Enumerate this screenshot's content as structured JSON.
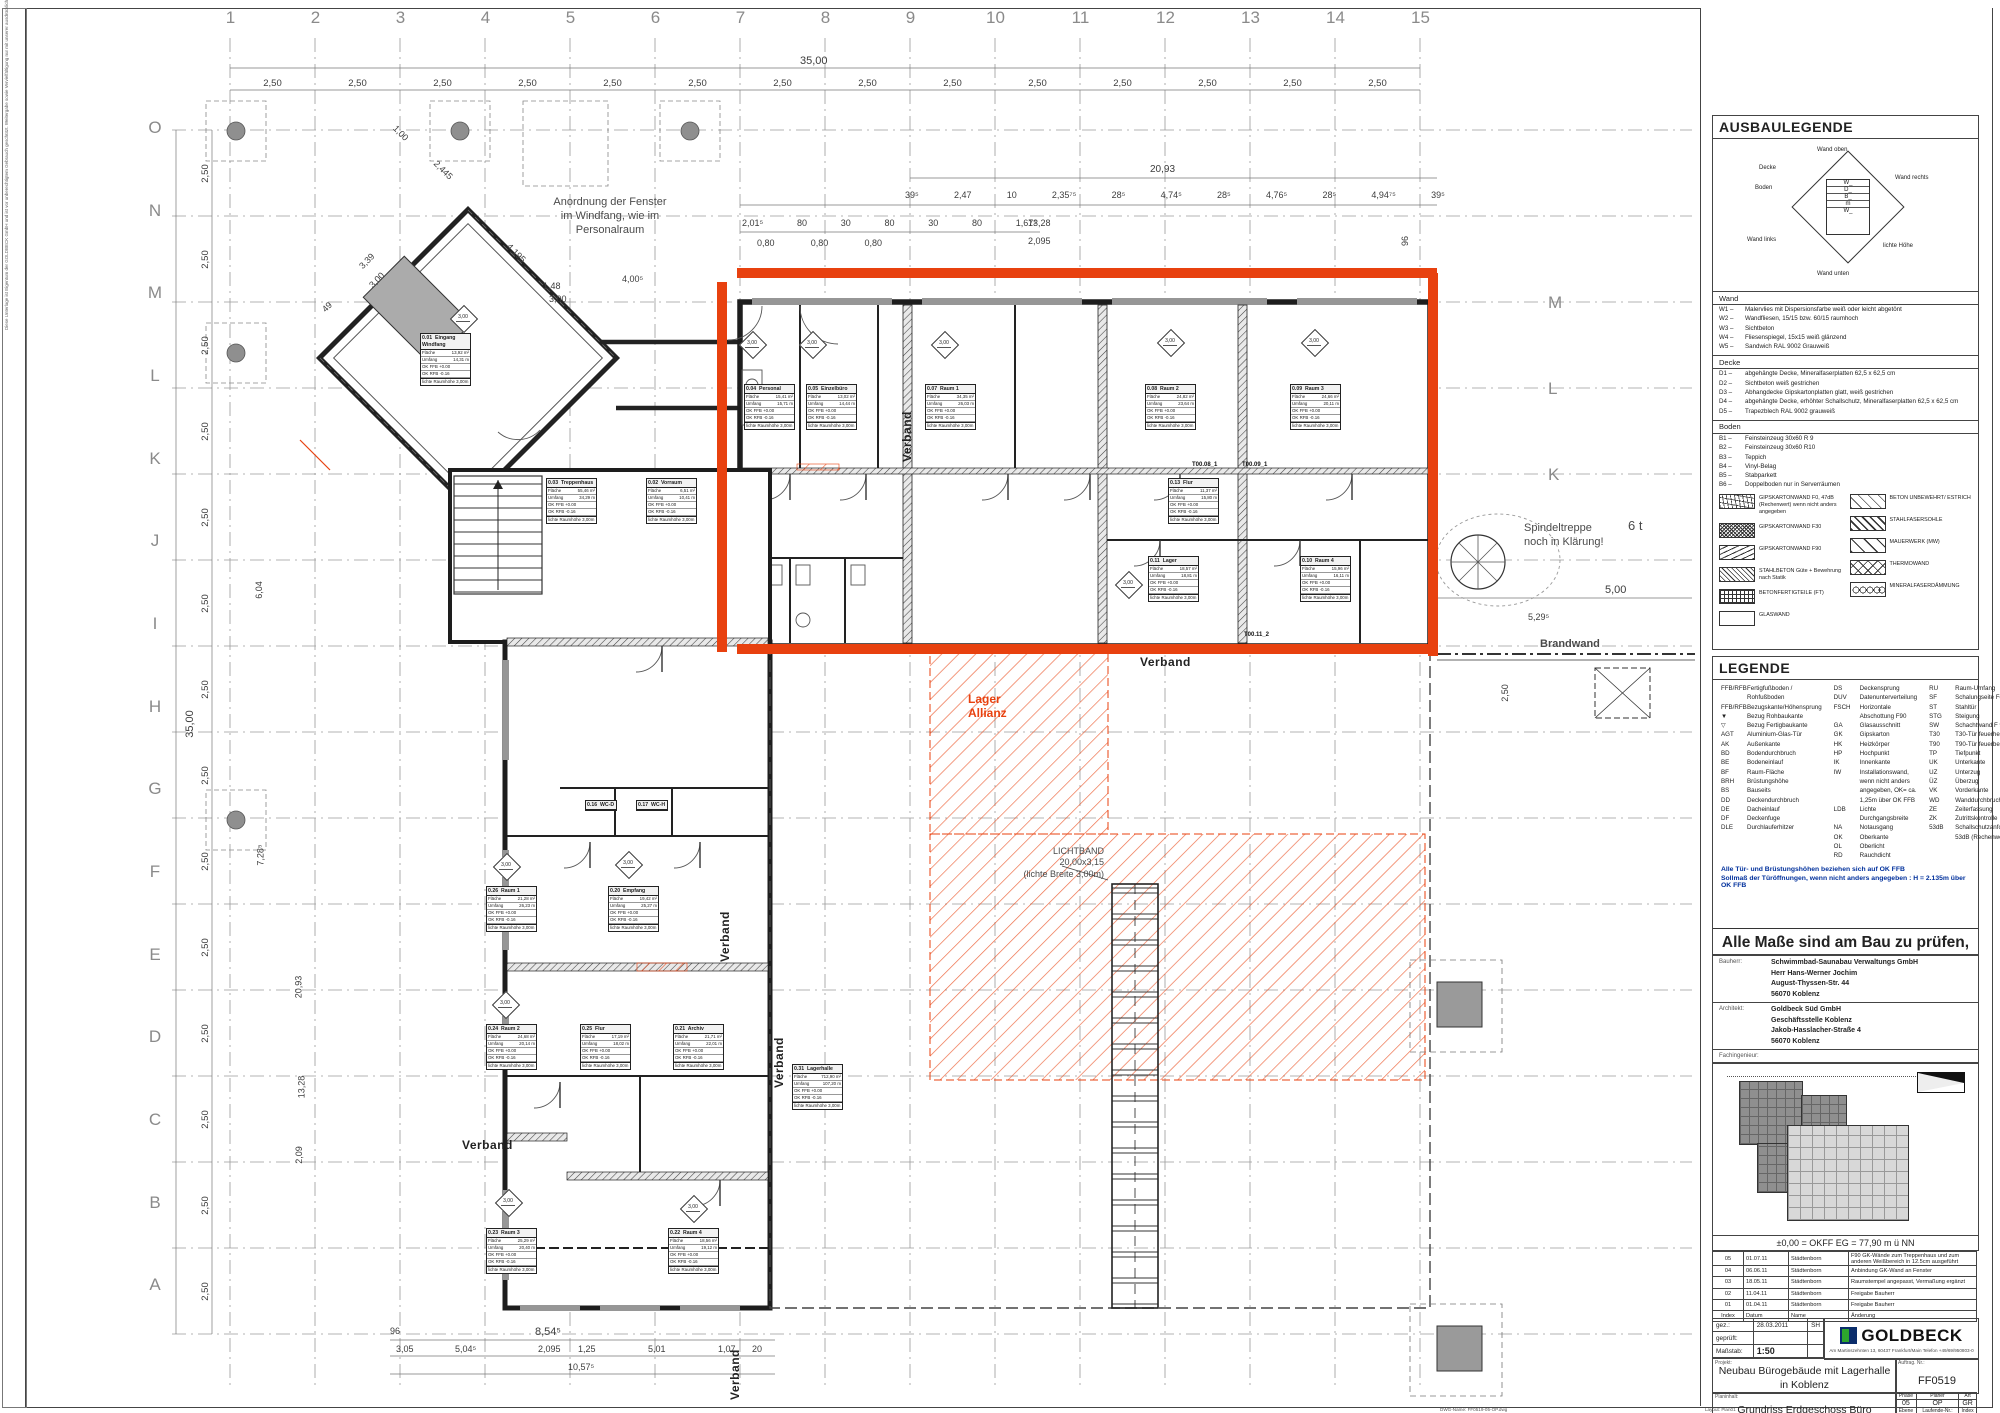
{
  "sheet": {
    "grid_numbers": [
      "1",
      "2",
      "3",
      "4",
      "5",
      "6",
      "7",
      "8",
      "9",
      "10",
      "11",
      "12",
      "13",
      "14",
      "15"
    ],
    "grid_letters": [
      "O",
      "N",
      "M",
      "L",
      "K",
      "J",
      "I",
      "H",
      "G",
      "F",
      "E",
      "D",
      "C",
      "B",
      "A"
    ],
    "grid_letters_right": [
      "M",
      "L",
      "K"
    ],
    "side_note": "Diese Unterlage ist Eigentum der GOLDBECK GmbH und ist vor unberechtigtem Gebrauch geschützt. Weitergabe sowie Vervielfältigung nur mit unserer ausdrücklichen Zustimmung. Copyright by GOLDBECK GmbH",
    "footer_left": "DWG-Name: FF0519-05-OP.dwg",
    "footer_right": "Layout: Plan01"
  },
  "plan": {
    "stamp_value": "3,00",
    "annotations": {
      "fenster1": "Anordnung der Fenster",
      "fenster2": "im Windfang, wie im",
      "fenster3": "Personalraum",
      "spindel1": "Spindeltreppe",
      "spindel2": "noch in Klärung!",
      "six_t": "6 t",
      "brandwand": "Brandwand",
      "verband": "Verband",
      "lager1": "Lager",
      "lager2": "Allianz",
      "lichtband1": "LICHTBAND",
      "lichtband2": "20,00x3,15",
      "lichtband3": "(lichte Breite 3,00m)"
    },
    "door_tags": {
      "t1": "T00.08_1",
      "t2": "T00.09_1",
      "t3": "T00.11_2"
    },
    "dims": {
      "top_overall": "35,00",
      "bay": "2,50",
      "d2093": "20,93",
      "row2": [
        "39⁵",
        "2,47",
        "10",
        "2,35⁷⁵",
        "28⁵",
        "4,74⁵",
        "28⁵",
        "4,76⁵",
        "28⁵",
        "4,94⁷⁵",
        "39⁵"
      ],
      "row3": [
        "2,01⁵",
        "80",
        "30",
        "80",
        "30",
        "80",
        "1,67⁵"
      ],
      "row3b": [
        "0,80",
        "0,80",
        "0,80"
      ],
      "d1328": "13,28",
      "d2095": "2,095",
      "v96": "96",
      "left_overall": "35,00",
      "l604": "6,04",
      "l728": "7,28⁵",
      "l2093": "20,93",
      "l1328": "13,28",
      "l209": "2,09",
      "m148": "1,48",
      "m300": "3,00",
      "m400": "4,00⁵",
      "p100": "1,00",
      "p2445": "2,445",
      "p4195": "4,195",
      "p339": "3,39",
      "p300": "3,00",
      "p49": "49",
      "r529": "5,29⁵",
      "r500": "5,00",
      "r250": "2,50",
      "b96": "96",
      "b854": "8,54⁵",
      "b305": "3,05",
      "b504": "5,04⁵",
      "b2095": "2,095",
      "b125": "1,25",
      "b501": "5,01",
      "b107": "1,07",
      "b20": "20",
      "b1057": "10,57⁵"
    }
  },
  "room_labels": {
    "flaeche": "Fläche",
    "umfang": "Umfang",
    "ok_ffb": "OK FFB +0.00",
    "ok_rfb": "OK RFB -0.16",
    "hoehe": "lichte Raumhöhe 3,00m",
    "m2": "m²",
    "m": "m"
  },
  "rooms": [
    {
      "id": "0.01",
      "name": "Eingang Windfang",
      "a": "13,92 m²",
      "u": "14,31 m"
    },
    {
      "id": "0.02",
      "name": "Vorraum",
      "a": "6,51 m²",
      "u": "10,41 m"
    },
    {
      "id": "0.03",
      "name": "Treppenhaus",
      "a": "55,46 m²",
      "u": "34,29 m"
    },
    {
      "id": "0.04",
      "name": "Personal",
      "a": "15,41 m²",
      "u": "15,71 m"
    },
    {
      "id": "0.05",
      "name": "Einzelbüro",
      "a": "13,02 m²",
      "u": "14,44 m"
    },
    {
      "id": "0.07",
      "name": "Raum 1",
      "a": "34,35 m²",
      "u": "26,03 m"
    },
    {
      "id": "0.08",
      "name": "Raum 2",
      "a": "24,82 m²",
      "u": "23,64 m"
    },
    {
      "id": "0.09",
      "name": "Raum 3",
      "a": "24,66 m²",
      "u": "20,11 m"
    },
    {
      "id": "0.10",
      "name": "Raum 4",
      "a": "15,96 m²",
      "u": "16,11 m"
    },
    {
      "id": "0.11",
      "name": "Lager",
      "a": "18,57 m²",
      "u": "18,81 m"
    },
    {
      "id": "0.13",
      "name": "Flur",
      "a": "11,37 m²",
      "u": "15,80 m"
    },
    {
      "id": "0.16",
      "name": "WC-D",
      "a": "",
      "u": ""
    },
    {
      "id": "0.17",
      "name": "WC-H",
      "a": "",
      "u": ""
    },
    {
      "id": "0.20",
      "name": "Empfang",
      "a": "19,42 m²",
      "u": "25,27 m"
    },
    {
      "id": "0.21",
      "name": "Archiv",
      "a": "21,71 m²",
      "u": "22,01 m"
    },
    {
      "id": "0.22",
      "name": "Raum 4",
      "a": "18,56 m²",
      "u": "19,12 m"
    },
    {
      "id": "0.23",
      "name": "Raum 3",
      "a": "25,29 m²",
      "u": "20,40 m"
    },
    {
      "id": "0.24",
      "name": "Raum 2",
      "a": "24,68 m²",
      "u": "20,14 m"
    },
    {
      "id": "0.25",
      "name": "Flur",
      "a": "17,19 m²",
      "u": "18,02 m"
    },
    {
      "id": "0.26",
      "name": "Raum 1",
      "a": "21,28 m²",
      "u": "26,23 m"
    },
    {
      "id": "0.31",
      "name": "Lagerhalle",
      "a": "712,90 m²",
      "u": "107,20 m"
    }
  ],
  "ausbaulegende": {
    "title": "AUSBAULEGENDE",
    "diagram": {
      "wand_oben": "Wand oben",
      "decke": "Decke",
      "boden": "Boden",
      "wand_rechts": "Wand rechts",
      "wand_links": "Wand links",
      "lichte_hoehe": "lichte Höhe",
      "wand_unten": "Wand unten",
      "c_top": "W_",
      "c_d": "D_",
      "c_b": "B_",
      "c_l": "W_",
      "c_r": "W_",
      "c_m": "m",
      "c_bot": "W_"
    },
    "sections": [
      {
        "name": "Wand",
        "items": [
          [
            "W1 –",
            "Malervlies mit Dispersionsfarbe weiß oder leicht abgetönt"
          ],
          [
            "W2 –",
            "Wandfliesen, 15/15 bzw. 60/15 raumhoch"
          ],
          [
            "W3 –",
            "Sichtbeton"
          ],
          [
            "W4 –",
            "Fliesenspiegel, 15x15 weiß glänzend"
          ],
          [
            "W5 –",
            "Sandwich RAL 9002 Grauweiß"
          ]
        ]
      },
      {
        "name": "Decke",
        "items": [
          [
            "D1 –",
            "abgehängte Decke, Mineralfaserplatten 62,5 x 62,5 cm"
          ],
          [
            "D2 –",
            "Sichtbeton weiß gestrichen"
          ],
          [
            "D3 –",
            "Abhangdecke Gipskartonplatten glatt, weiß gestrichen"
          ],
          [
            "D4 –",
            "abgehängte Decke, erhöhter Schallschutz, Mineralfaserplatten 62,5 x 62,5 cm"
          ],
          [
            "D5 –",
            "Trapezblech RAL 9002 grauweiß"
          ]
        ]
      },
      {
        "name": "Boden",
        "items": [
          [
            "B1 –",
            "Feinsteinzeug 30x60 R 9"
          ],
          [
            "B2 –",
            "Feinsteinzeug 30x60 R10"
          ],
          [
            "B3 –",
            "Teppich"
          ],
          [
            "B4 –",
            "Vinyl-Belag"
          ],
          [
            "B5 –",
            "Stabparkett"
          ],
          [
            "B6 –",
            "Doppelboden nur in Serverräumen"
          ]
        ]
      }
    ],
    "hatch_left": [
      {
        "pattern": "p-zigzag",
        "label": "GIPSKARTONWAND F0, 47dB (Rechenwert) wenn nicht anders angegeben"
      },
      {
        "pattern": "p-dense",
        "label": "GIPSKARTONWAND F30"
      },
      {
        "pattern": "p-lines",
        "label": "GIPSKARTONWAND F90"
      },
      {
        "pattern": "p-diag-dense",
        "label": "STAHLBETON Güte + Bewehrung nach Statik"
      },
      {
        "pattern": "p-grid",
        "label": "BETONFERTIGTEILE (FT)"
      },
      {
        "pattern": "p-empty",
        "label": "GLASWAND"
      }
    ],
    "hatch_right": [
      {
        "pattern": "p-diag-sparse",
        "label": "BETON UNBEWEHRT/ ESTRICH"
      },
      {
        "pattern": "p-diag2",
        "label": "STAHLFASERSOHLE"
      },
      {
        "pattern": "p-mw",
        "label": "MAUERWERK (MW)"
      },
      {
        "pattern": "p-cross",
        "label": "THERMOWAND"
      },
      {
        "pattern": "p-loops",
        "label": "MINERALFASERDÄMMUNG"
      }
    ]
  },
  "legende": {
    "title": "LEGENDE",
    "col1": [
      [
        "FFB/RFB",
        "Fertigfußboden / Rohfußboden"
      ],
      [
        "FFB/RFB",
        "Bezugskante/Höhensprung"
      ],
      [
        "▼",
        "Bezug Rohbaukante"
      ],
      [
        "▽",
        "Bezug Fertigbaukante"
      ],
      [
        "AGT",
        "Aluminium-Glas-Tür"
      ],
      [
        "AK",
        "Außenkante"
      ],
      [
        "BD",
        "Bodendurchbruch"
      ],
      [
        "BE",
        "Bodeneinlauf"
      ],
      [
        "BF",
        "Raum-Fläche"
      ],
      [
        "BRH",
        "Brüstungshöhe"
      ],
      [
        "BS",
        "Bauseits"
      ],
      [
        "DD",
        "Deckendurchbruch"
      ],
      [
        "DE",
        "Dacheinlauf"
      ],
      [
        "DF",
        "Deckenfuge"
      ],
      [
        "DLE",
        "Durchlauferhitzer"
      ]
    ],
    "col2": [
      [
        "DS",
        "Deckensprung"
      ],
      [
        "DUV",
        "Datenunterverteilung"
      ],
      [
        "FSCH",
        "Horizontale Abschottung F90"
      ],
      [
        "GA",
        "Glasausschnitt"
      ],
      [
        "GK",
        "Gipskarton"
      ],
      [
        "HK",
        "Heizkörper"
      ],
      [
        "HP",
        "Hochpunkt"
      ],
      [
        "IK",
        "Innenkante"
      ],
      [
        "IW",
        "Installationswand, wenn nicht anders angegeben, OK= ca. 1,25m über OK FFB"
      ],
      [
        "LDB",
        "Lichte Durchgangsbreite"
      ],
      [
        "NA",
        "Notausgang"
      ],
      [
        "OK",
        "Oberkante"
      ],
      [
        "OL",
        "Oberlicht"
      ],
      [
        "RD",
        "Rauchdicht"
      ]
    ],
    "col3": [
      [
        "RU",
        "Raum-Umfang"
      ],
      [
        "SF",
        "Schalungseite Fertigteil"
      ],
      [
        "ST",
        "Stahltür"
      ],
      [
        "STG",
        "Steigung"
      ],
      [
        "SW",
        "Schachtwand F 90A"
      ],
      [
        "T30",
        "T30-Tür feuerhemmend"
      ],
      [
        "T90",
        "T90-Tür feuerbeständig"
      ],
      [
        "TP",
        "Tiefpunkt"
      ],
      [
        "UK",
        "Unterkante"
      ],
      [
        "UZ",
        "Unterzug"
      ],
      [
        "ÜZ",
        "Überzug"
      ],
      [
        "VK",
        "Vorderkante"
      ],
      [
        "WD",
        "Wanddurchbruch"
      ],
      [
        "ZE",
        "Zeiterfassung"
      ],
      [
        "ZK",
        "Zutrittskontrolle"
      ],
      [
        "53dB",
        "Schallschutzanforderung: 53dB (Rechenwert)"
      ]
    ]
  },
  "notes": {
    "note1": "Alle Tür- und Brüstungshöhen beziehen sich auf OK FFB",
    "note2": "Sollmaß der Türöffnungen, wenn nicht anders angegeben :  H = 2.135m über OK FFB",
    "warn1": "Alle Maße sind am Bau zu prüfen, und mit",
    "warn2": "den Angaben des Statikers abzustimmen",
    "release1": "Diese Zeichnung wurde von uns geprüft und mit den einge-",
    "release2": "tragenen Änderungen zur Ausführungsplanung freigegeben.",
    "datum_label": "DATUM",
    "bauherr_label": "BAUHERR/VERTRETER"
  },
  "parties": {
    "bauherr_label": "Bauherr:",
    "bauherr": [
      "Schwimmbad-Saunabau Verwaltungs GmbH",
      "Herr Hans-Werner Jochim",
      "August-Thyssen-Str. 44",
      "56070 Koblenz"
    ],
    "architekt_label": "Architekt:",
    "architekt": [
      "Goldbeck Süd GmbH",
      "Geschäftsstelle Koblenz",
      "Jakob-Hasslacher-Straße 4",
      "56070 Koblenz"
    ],
    "fachingenieur_label": "Fachingenieur:"
  },
  "site": {
    "level_note": "±0,00  =  OKFF EG  =  77,90 m ü NN"
  },
  "revisions": {
    "header": [
      "Index",
      "Datum",
      "Name",
      "Änderung"
    ],
    "rows": [
      [
        "05",
        "01.07.11",
        "Städtenborn",
        "F90 GK-Wände zum Treppenhaus und zum anderen Weißbereich in 12.5cm ausgeführt"
      ],
      [
        "04",
        "06.06.11",
        "Städtenborn",
        "Anbindung GK-Wand an Fenster"
      ],
      [
        "03",
        "18.05.11",
        "Städtenborn",
        "Raumstempel angepasst, Vermaßung ergänzt"
      ],
      [
        "02",
        "11.04.11",
        "Städtenborn",
        "Freigabe Bauherr"
      ],
      [
        "01",
        "01.04.11",
        "Städtenborn",
        "Freigabe Bauherr"
      ]
    ]
  },
  "titleblock": {
    "gez_label": "gez.:",
    "gez_date": "28.03.2011",
    "gez_name": "SH",
    "geprueft_label": "geprüft:",
    "massstab_label": "Maßstab:",
    "massstab": "1:50",
    "logo": "GOLDBECK",
    "logo_addr": "Am Martinszehnten 13, 60437 Frankfurt/Main     Telefon +49/69/950803-0",
    "projekt_label": "Projekt:",
    "projekt1": "Neubau Bürogebäude mit Lagerhalle",
    "projekt2": "in Koblenz",
    "auftrag_label": "Auftrag. Nr.:",
    "auftrag": "FF0519",
    "planinhalt_label": "Planinhalt:",
    "planinhalt": "Grundriss Erdgeschoss Büro",
    "codes": {
      "phase_l": "Phase",
      "phase": "05",
      "planer_l": "Planer",
      "planer": "OP",
      "art_l": "Art",
      "art": "GR",
      "ebene_l": "Ebene",
      "ebene": "00",
      "lfd_l": "Laufende-Nr.:",
      "lfd": "00100",
      "index_l": "Index",
      "index": "5"
    }
  },
  "colors": {
    "markup_red": "#e8410f",
    "line": "#2b2b2b",
    "grid": "#9a9a9a"
  }
}
